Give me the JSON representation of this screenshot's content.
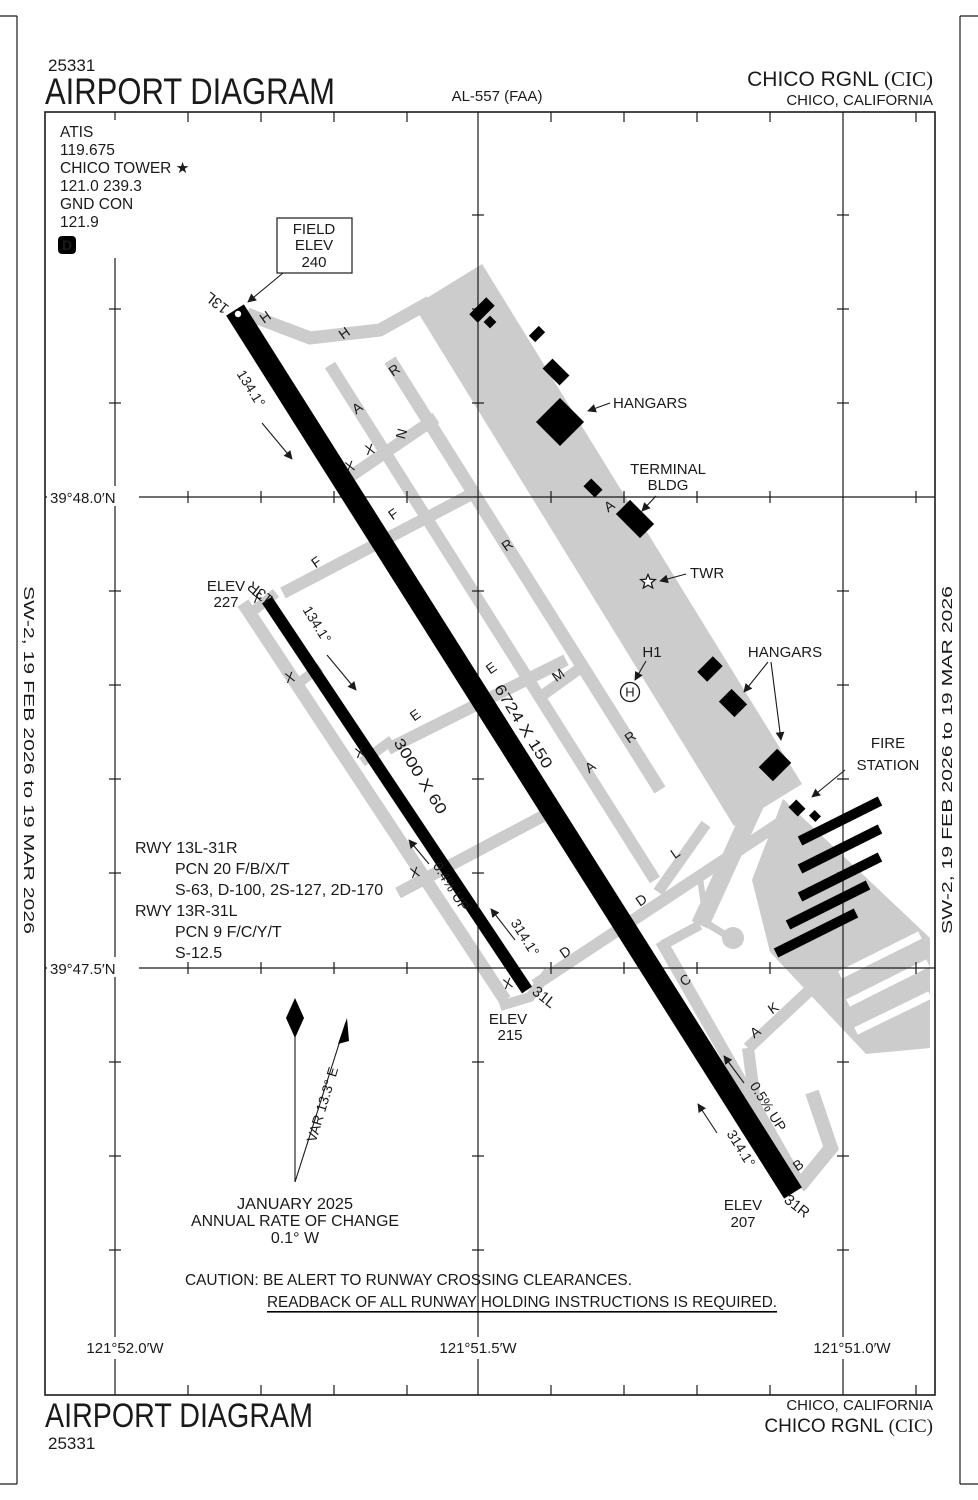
{
  "header": {
    "chart_number": "25331",
    "title": "AIRPORT DIAGRAM",
    "chart_code": "AL-557 (FAA)",
    "airport_name": "CHICO RGNL",
    "airport_icao": "(CIC)",
    "city": "CHICO, CALIFORNIA"
  },
  "edge_note": {
    "left": "SW-2,  19 FEB 2026  to  19 MAR 2026",
    "right": "SW-2,  19 FEB 2026  to  19 MAR 2026"
  },
  "comm": {
    "atis_label": "ATIS",
    "atis_freq": "119.675",
    "tower_label": "CHICO TOWER ★",
    "tower_freqs": "121.0  239.3",
    "ground_label": "GND CON",
    "ground_freq": "121.9",
    "departure_symbol": "D"
  },
  "field_elev": {
    "line1": "FIELD",
    "line2": "ELEV",
    "line3": "240"
  },
  "graticule": {
    "lat": [
      "39°48.0′N",
      "39°47.5′N"
    ],
    "lon": [
      "121°52.0′W",
      "121°51.5′W",
      "121°51.0′W"
    ]
  },
  "runways": {
    "main": {
      "num_top": "13L",
      "num_bottom": "31R",
      "dim": "6724 X 150",
      "hdg_top": "134.1°",
      "hdg_bottom": "314.1°",
      "gradient": "0.5% UP"
    },
    "secondary": {
      "num_top": "13R",
      "num_bottom": "31L",
      "dim": "3000 X 60",
      "hdg_top": "134.1°",
      "hdg_bottom": "314.1°",
      "gradient": "0.4% UP"
    }
  },
  "elevations": {
    "e13r": {
      "label": "ELEV",
      "value": "227"
    },
    "e31l": {
      "label": "ELEV",
      "value": "215"
    },
    "e31r": {
      "label": "ELEV",
      "value": "207"
    }
  },
  "runway_data": [
    "RWY 13L-31R",
    "PCN 20 F/B/X/T",
    "S-63, D-100, 2S-127, 2D-170",
    "RWY 13R-31L",
    "PCN 9 F/C/Y/T",
    "S-12.5"
  ],
  "features": {
    "hangars_north": "HANGARS",
    "terminal_line1": "TERMINAL",
    "terminal_line2": "BLDG",
    "tower": "TWR",
    "helipad": "H1",
    "helipad_symbol": "H",
    "hangars_east": "HANGARS",
    "fire_line1": "FIRE",
    "fire_line2": "STATION"
  },
  "taxiway_letters": [
    "H",
    "H",
    "R",
    "A",
    "N",
    "X",
    "X",
    "F",
    "A",
    "F",
    "X",
    "R",
    "X",
    "E",
    "M",
    "E",
    "R",
    "X",
    "A",
    "X",
    "L",
    "D",
    "D",
    "C",
    "K",
    "A",
    "B",
    "X"
  ],
  "variation": {
    "arrow_label": "VAR 13.3° E",
    "date": "JANUARY 2025",
    "rate_label": "ANNUAL RATE OF CHANGE",
    "rate_value": "0.1° W"
  },
  "caution": {
    "line1": "CAUTION: BE ALERT TO RUNWAY CROSSING CLEARANCES.",
    "line2": "READBACK OF ALL RUNWAY HOLDING INSTRUCTIONS IS REQUIRED."
  },
  "footer": {
    "city": "CHICO, CALIFORNIA",
    "airport_name": "CHICO RGNL",
    "airport_icao": "(CIC)",
    "title": "AIRPORT DIAGRAM",
    "chart_number": "25331"
  }
}
